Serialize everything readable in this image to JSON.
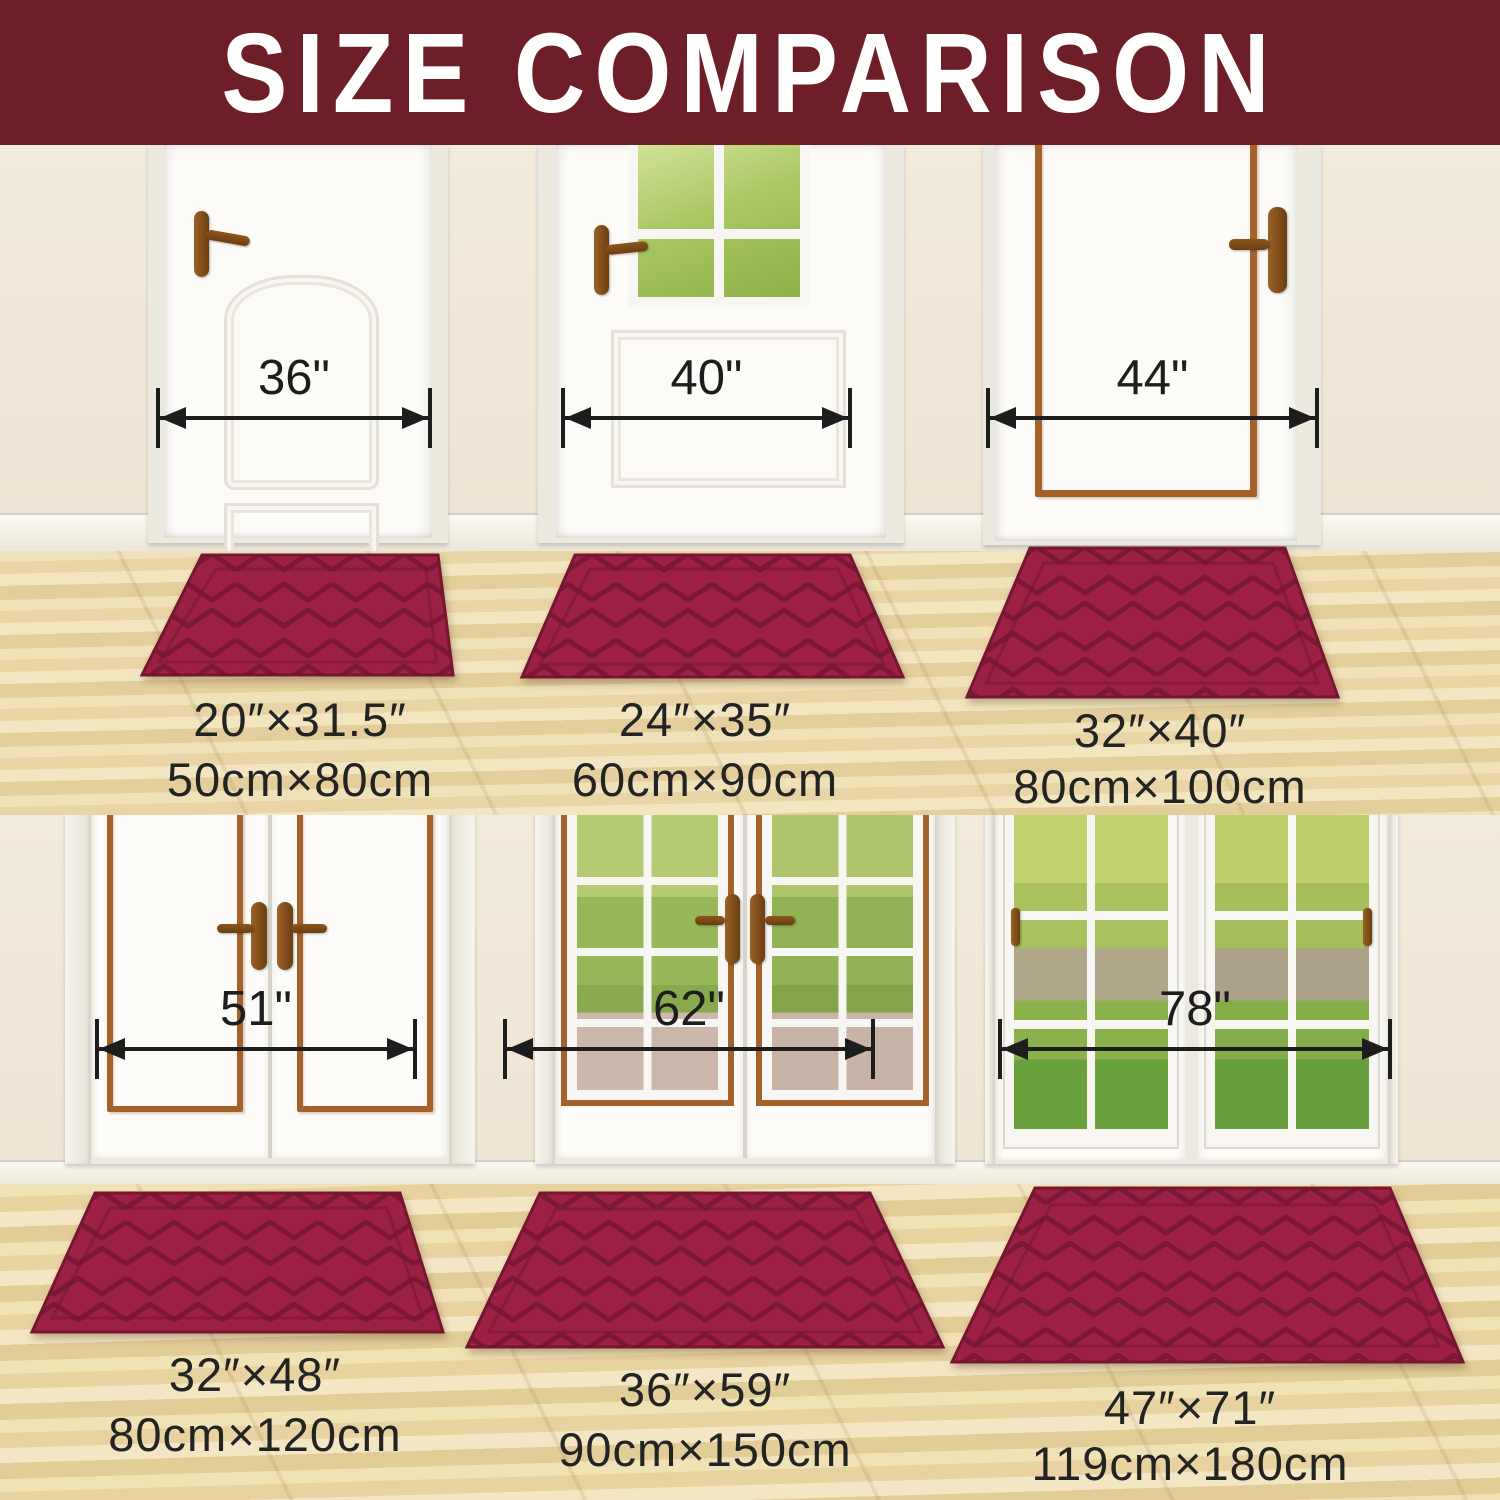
{
  "header": {
    "title": "SIZE COMPARISON"
  },
  "colors": {
    "banner_bg": "#6e1e28",
    "banner_text": "#ffffff",
    "mat_red": "#9d2144",
    "mat_groove": "#6f1530",
    "wall_cream": "#f2ead9",
    "floor_wood": "#ead7a8",
    "door_trim_brown": "#a4622a",
    "handle_brown": "#8a5520",
    "measure_ink": "#1d1d1d",
    "label_ink": "#232323"
  },
  "scenes": [
    {
      "label": "single doors",
      "doors": [
        {
          "door_width": "36\"",
          "mat_inches": "20″×31.5″",
          "mat_cm": "50cm×80cm"
        },
        {
          "door_width": "40\"",
          "mat_inches": "24″×35″",
          "mat_cm": "60cm×90cm"
        },
        {
          "door_width": "44\"",
          "mat_inches": "32″×40″",
          "mat_cm": "80cm×100cm"
        }
      ]
    },
    {
      "label": "double doors",
      "doors": [
        {
          "door_width": "51\"",
          "mat_inches": "32″×48″",
          "mat_cm": "80cm×120cm"
        },
        {
          "door_width": "62\"",
          "mat_inches": "36″×59″",
          "mat_cm": "90cm×150cm"
        },
        {
          "door_width": "78\"",
          "mat_inches": "47″×71″",
          "mat_cm": "119cm×180cm"
        }
      ]
    }
  ]
}
